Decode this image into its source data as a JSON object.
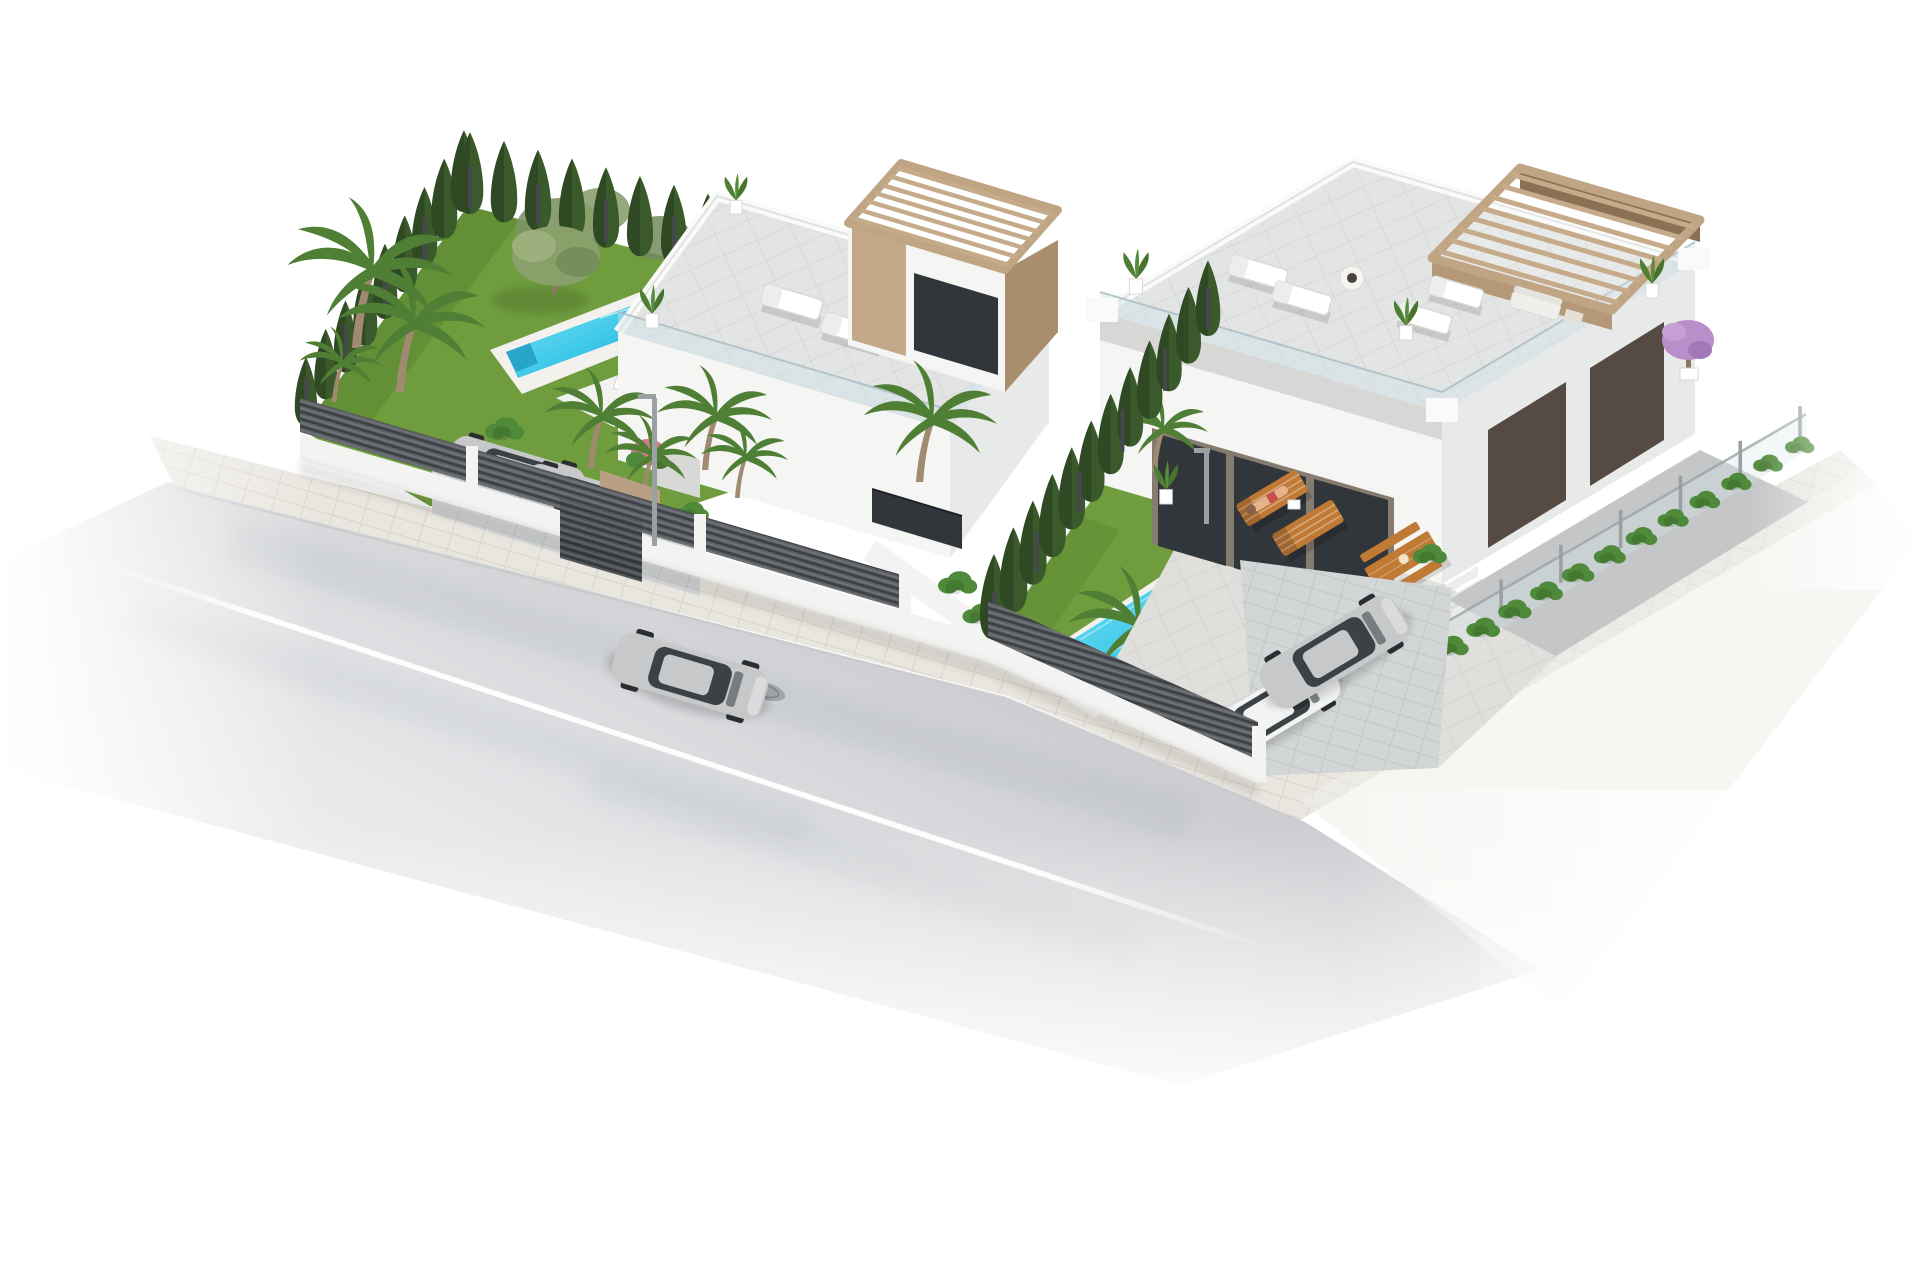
{
  "scene": {
    "type": "aerial-3d-architectural-render",
    "background": "#ffffff",
    "description": "Isometric aerial 3D render of two modern white villas with rooftop terraces and wooden pergolas, green gardens with pools and hedges, fenced driveways with parked cars, and a light gray street with a silver sedan driving past",
    "inventory": {
      "villas": 2,
      "pools": 2,
      "cars_total": 5,
      "people": 1,
      "street_lamps": 2,
      "cars": [
        "silver sedan driving on the road",
        "two silver cars parked in the left villa driveway behind a slatted gate",
        "silver coupe parked in the right villa driveway",
        "white compact car parked in the right villa driveway"
      ],
      "left_villa_features": [
        "rooftop terrace with two white sun loungers",
        "upper tower with tan slatted pergola",
        "narrow lap pool with white deck",
        "lawn garden with olive tree and palm trees",
        "conifer hedge boundaries",
        "gray slatted street fence with gate",
        "white garden dining set"
      ],
      "right_villa_features": [
        "large rooftop terrace with sun loungers and round fire table",
        "tan slatted pergola lounge corner",
        "glass balustrades",
        "ground floor glass facade with wood mullions",
        "paved patio with wooden dining table and benches",
        "two wooden sun loungers, one with a sunbathing person",
        "rectangular turquoise pool with steps and palm",
        "conifer hedge between plots",
        "low hedge with glass fence on right boundary",
        "dark garage doors and side yard"
      ]
    }
  },
  "palette": {
    "background": "#ffffff",
    "road": "#ced0d3",
    "roadFar": "#f4f5f6",
    "laneLine": "#ffffff",
    "sidewalk": "#e9e6df",
    "fenceSlat": "#5f6367",
    "fencePost": "#45484c",
    "wallWhite": "#f3f3f1",
    "lawn": "#6f9d3e",
    "lawnShade": "#55832f",
    "conifer": "#3a5a2c",
    "bush": "#4e8a3a",
    "palm": "#4f7f34",
    "oliveTree": "#8aa06b",
    "poolWater": "#3ec9e9",
    "poolWaterDeep": "#1fa9d2",
    "poolRim": "#f2f1ed",
    "deck": "#e3e4e4",
    "parapet": "#fafaf9",
    "glassRail": "#cfe3e9",
    "buildingWhite": "#f5f5f4",
    "buildingShade": "#e8e9e9",
    "windowDark": "#31363a",
    "pergolaTan": "#c3a98a",
    "pergolaTanDark": "#a98e6e",
    "garageDark": "#564b42",
    "patio": "#e0dfdc",
    "sideYard": "#d3d6d7",
    "carSilver": "#c6c8ca",
    "carWhite": "#f2f3f3",
    "carGlass": "#3c4145",
    "woodFurniture": "#c07a36",
    "skin": "#e6b28c",
    "purpleTree": "#b98fc9",
    "potWhite": "#ffffff",
    "lampGray": "#9ba0a3",
    "manhole": "#9aa0a4",
    "pinkFlowers": "#d4798c"
  },
  "generated": {
    "lines": [
      {
        "sym": "sym-conifer",
        "layer": "lw-hedge-west",
        "color": "conifer",
        "x1": 306,
        "y1": 426,
        "x2": 464,
        "y2": 212,
        "count": 9,
        "s0": 0.8,
        "s1": 0.95
      },
      {
        "sym": "sym-post",
        "layer": "lw-posts-west",
        "color": "fencePost",
        "x1": 306,
        "y1": 420,
        "x2": 464,
        "y2": 206,
        "count": 5,
        "s0": 1
      },
      {
        "sym": "sym-conifer",
        "layer": "lw-hedge-back",
        "color": "conifer",
        "x1": 470,
        "y1": 214,
        "x2": 946,
        "y2": 332,
        "count": 15,
        "s0": 0.95,
        "s1": 0.9
      },
      {
        "sym": "sym-post",
        "layer": "lw-posts-back",
        "color": "fencePost",
        "x1": 470,
        "y1": 208,
        "x2": 946,
        "y2": 326,
        "count": 8,
        "s0": 1
      },
      {
        "sym": "sym-conifer",
        "layer": "mid-hedge",
        "color": "conifer",
        "x1": 994,
        "y1": 640,
        "x2": 1208,
        "y2": 336,
        "count": 12,
        "s0": 1.0,
        "s1": 0.88
      },
      {
        "sym": "sym-post",
        "layer": "mid-posts",
        "color": "fencePost",
        "x1": 994,
        "y1": 634,
        "x2": 1208,
        "y2": 330,
        "count": 6,
        "s0": 1
      },
      {
        "sym": "sym-bush",
        "layer": "r-hedge-right",
        "color": "bush",
        "x1": 1262,
        "y1": 764,
        "x2": 1800,
        "y2": 452,
        "count": 18,
        "s0": 0.75,
        "s1": 0.6
      },
      {
        "sym": "sym-post",
        "layer": "r-posts-right",
        "color": "lampGray",
        "x1": 1262,
        "y1": 756,
        "x2": 1800,
        "y2": 444,
        "count": 10,
        "s0": 0.9
      }
    ],
    "items": [
      {
        "sym": "sym-palm",
        "layer": "lw-palms",
        "color": "palm",
        "x": 352,
        "y": 348,
        "s": 1.8
      },
      {
        "sym": "sym-palm",
        "layer": "lw-palms",
        "color": "palm",
        "x": 396,
        "y": 392,
        "s": 1.6
      },
      {
        "sym": "sym-palm",
        "layer": "lw-palms",
        "color": "palm",
        "x": 332,
        "y": 402,
        "s": 0.9
      },
      {
        "sym": "sym-palm",
        "layer": "lw-drive-plants",
        "color": "palm",
        "x": 588,
        "y": 468,
        "s": 1.2
      },
      {
        "sym": "sym-palm",
        "layer": "lw-drive-plants",
        "color": "palm",
        "x": 641,
        "y": 499,
        "s": 1.0
      },
      {
        "sym": "sym-palm",
        "layer": "v-palms",
        "color": "palm",
        "x": 702,
        "y": 470,
        "s": 1.25
      },
      {
        "sym": "sym-palm",
        "layer": "v-palms",
        "color": "palm",
        "x": 735,
        "y": 498,
        "s": 0.95
      },
      {
        "sym": "sym-palm",
        "layer": "v-palms",
        "color": "palm",
        "x": 916,
        "y": 482,
        "s": 1.45
      },
      {
        "sym": "sym-bush",
        "layer": "lw-drive-plants",
        "color": "bush",
        "x": 505,
        "y": 438,
        "s": 0.8
      },
      {
        "sym": "sym-bush",
        "layer": "lw-drive-plants",
        "color": "bush",
        "x": 692,
        "y": 520,
        "s": 0.7
      },
      {
        "sym": "sym-bush",
        "layer": "v-palms",
        "color": "bush",
        "x": 958,
        "y": 592,
        "s": 0.8
      },
      {
        "sym": "sym-bush",
        "layer": "v-palms",
        "color": "bush",
        "x": 980,
        "y": 622,
        "s": 0.7
      },
      {
        "sym": "sym-pot",
        "layer": "lv-roof-pots",
        "x": 652,
        "y": 328,
        "s": 0.9
      },
      {
        "sym": "sym-pot",
        "layer": "lv-roof-pots",
        "x": 736,
        "y": 214,
        "s": 0.85
      },
      {
        "sym": "sym-pot",
        "layer": "lv-roof-pots",
        "x": 1014,
        "y": 300,
        "s": 0.85
      },
      {
        "sym": "sym-palm",
        "layer": "r-pool-palm",
        "color": "palm",
        "x": 1122,
        "y": 692,
        "s": 1.5
      },
      {
        "sym": "sym-bush",
        "layer": "r-lawn-bushes",
        "color": "bush",
        "x": 1010,
        "y": 648,
        "s": 0.6
      },
      {
        "sym": "sym-bush",
        "layer": "r-lawn-bushes",
        "color": "bush",
        "x": 1250,
        "y": 702,
        "s": 0.8
      },
      {
        "sym": "sym-bush",
        "layer": "r-lawn-bushes",
        "color": "bush",
        "x": 1286,
        "y": 722,
        "s": 0.7
      },
      {
        "sym": "sym-bush",
        "layer": "r-front-plants",
        "color": "bush",
        "x": 1430,
        "y": 562,
        "s": 0.7
      },
      {
        "sym": "sym-palm",
        "layer": "r-front-plants",
        "color": "palm",
        "x": 1152,
        "y": 472,
        "s": 1.0
      },
      {
        "sym": "sym-pot",
        "layer": "rv-roof-pots",
        "x": 1136,
        "y": 294,
        "s": 0.95
      },
      {
        "sym": "sym-pot",
        "layer": "rv-roof-pots",
        "x": 1406,
        "y": 340,
        "s": 0.9
      },
      {
        "sym": "sym-pot",
        "layer": "rv-roof-pots",
        "x": 1652,
        "y": 298,
        "s": 0.9
      },
      {
        "sym": "sym-pot",
        "layer": "r-front-plants",
        "x": 1166,
        "y": 504,
        "s": 0.9
      }
    ]
  }
}
